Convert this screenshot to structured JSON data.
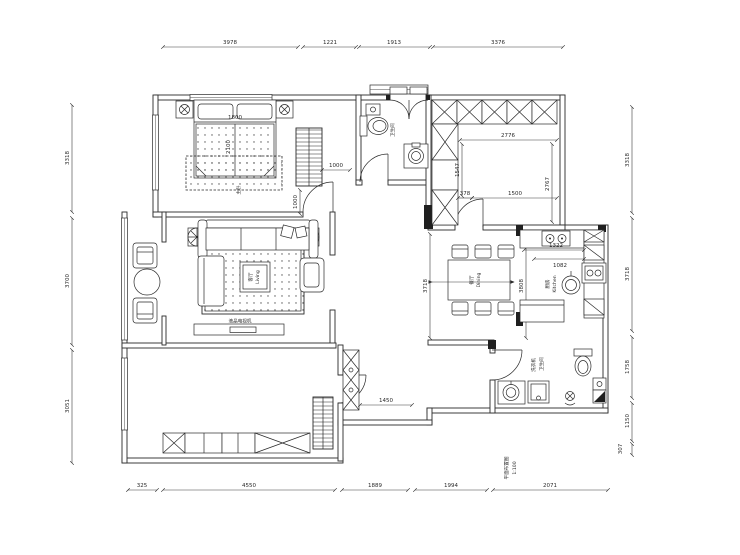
{
  "plan": {
    "dims_top": [
      "3978",
      "1221",
      "1913",
      "3376"
    ],
    "dims_left": [
      "3318",
      "3700",
      "3051"
    ],
    "dims_right": [
      "3318",
      "3718",
      "1758",
      "1150",
      "307"
    ],
    "dims_bottom": [
      "325",
      "4550",
      "1889",
      "1994",
      "2071"
    ],
    "dims_inner": {
      "bed_w": "1800",
      "bed_l": "2100",
      "ward_w": "1000",
      "ward_h": "1000",
      "rt_a": "2776",
      "rt_b": "1547",
      "rt_c": "378",
      "rt_d": "1500",
      "rt_e": "2767",
      "kt_a": "1322",
      "kt_b": "1082",
      "dn_a": "3718",
      "dn_b": "3808",
      "hall_a": "1450"
    },
    "labels": {
      "living_cn": "客厅",
      "living_en": "Living",
      "dining_cn": "餐厅",
      "dining_en": "Dining",
      "kitchen_cn": "厨房",
      "kitchen_en": "Kitchen",
      "bath_top": "卫生间",
      "bath_bottom": "卫生间",
      "laundry": "洗衣机",
      "master": "主卧",
      "tv": "液晶电视机",
      "caption1": "平面布置图",
      "caption2": "1:100"
    }
  }
}
